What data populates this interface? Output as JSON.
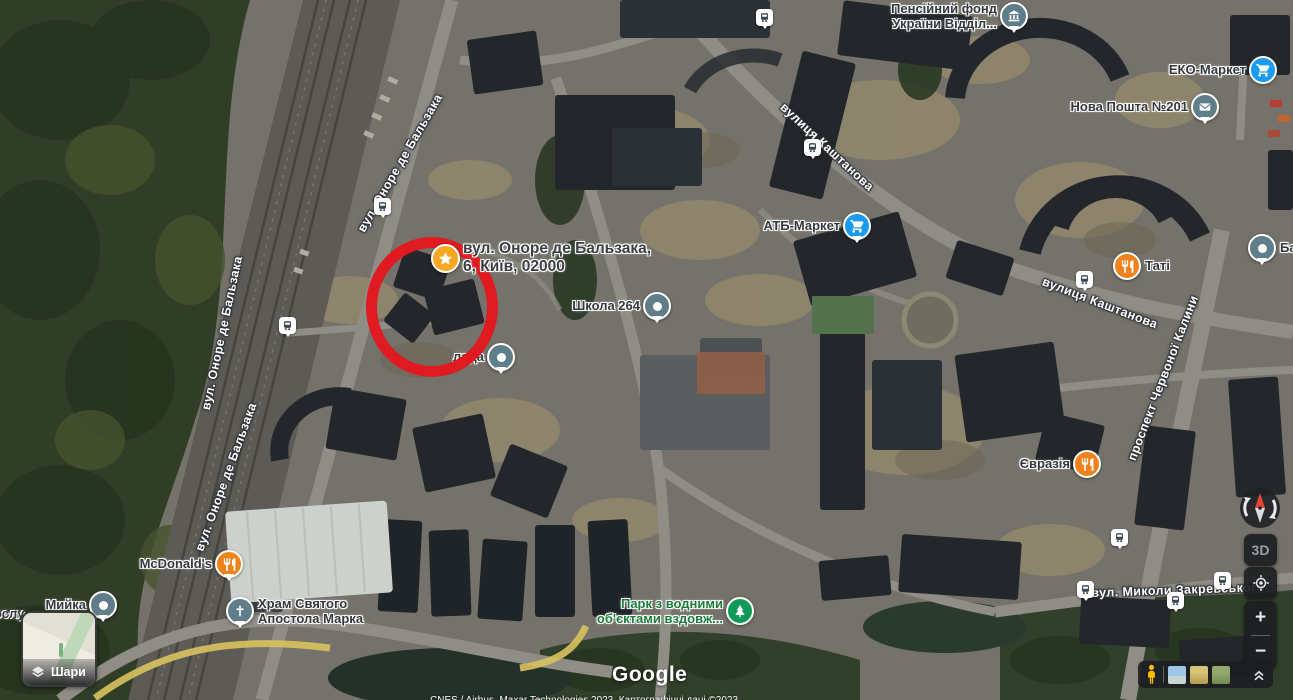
{
  "map": {
    "google_logo": "Google",
    "attribution": "CNES / Airbus, Maxar Technologies 2023, Картографічні дані ©2023",
    "partial_label_left": "ослу"
  },
  "annotation": {
    "shape": "circle",
    "color": "#df1a20"
  },
  "address_marker": {
    "line1": "вул. Оноре де Бальзака,",
    "line2": "6, Київ, 02000",
    "icon": "star-icon",
    "icon_color": "#f6a821"
  },
  "pois": {
    "pension_fund": {
      "line1": "Пенсійний фонд",
      "line2": "України Відділ...",
      "icon": "bank-icon",
      "icon_color": "#5f7e8a"
    },
    "eko_market": {
      "label": "ЕКО-Маркет",
      "icon": "shopping-cart-icon",
      "icon_color": "#1a9bf0"
    },
    "nova_poshta": {
      "label": "Нова Пошта №201",
      "icon": "mail-icon",
      "icon_color": "#5f7e8a"
    },
    "atb_market": {
      "label": "АТБ-Маркет",
      "icon": "shopping-cart-icon",
      "icon_color": "#1a9bf0"
    },
    "tati": {
      "label": "Таті",
      "icon": "restaurant-icon",
      "icon_color": "#f0821e"
    },
    "school_264": {
      "label": "Школа 264",
      "icon": "place-pin-icon",
      "icon_color": "#5f7e8a"
    },
    "lada_partial": {
      "label": "лада",
      "icon": "place-pin-icon",
      "icon_color": "#5f7e8a"
    },
    "evrazia": {
      "label": "Євразія",
      "icon": "restaurant-icon",
      "icon_color": "#f0821e"
    },
    "mcdonalds": {
      "label": "McDonald's",
      "icon": "restaurant-icon",
      "icon_color": "#f0821e"
    },
    "hram": {
      "line1": "Храм Святого",
      "line2": "Апостола Марка",
      "icon": "church-icon",
      "icon_color": "#5f7e8a"
    },
    "myika": {
      "label": "Мийка",
      "icon": "place-pin-icon",
      "icon_color": "#5f7e8a"
    },
    "park": {
      "line1": "Парк з водними",
      "line2": "об'єктами вздовж...",
      "icon": "park-tree-icon",
      "icon_color": "#109a58",
      "text_color": "#1b7d3c"
    },
    "ba_partial": {
      "label": "Ба",
      "icon": "place-pin-icon",
      "icon_color": "#5f7e8a"
    }
  },
  "streets": {
    "balzaka_top": "вул. Оноре де Бальзака",
    "balzaka_mid": "вул. Оноре де Бальзака",
    "balzaka_low": "вул. Оноре де Бальзака",
    "kashtanova_top": "вулиця Каштанова",
    "kashtanova_east": "вулиця Каштанова",
    "chervonoi_kalyny": "проспект Червоної Калини",
    "zakrevskoho": "вул. Миколи Закревського"
  },
  "controls": {
    "layers_button_label": "Шари",
    "map_3d_label": "3D",
    "zoom_in_label": "+",
    "zoom_out_label": "−"
  }
}
